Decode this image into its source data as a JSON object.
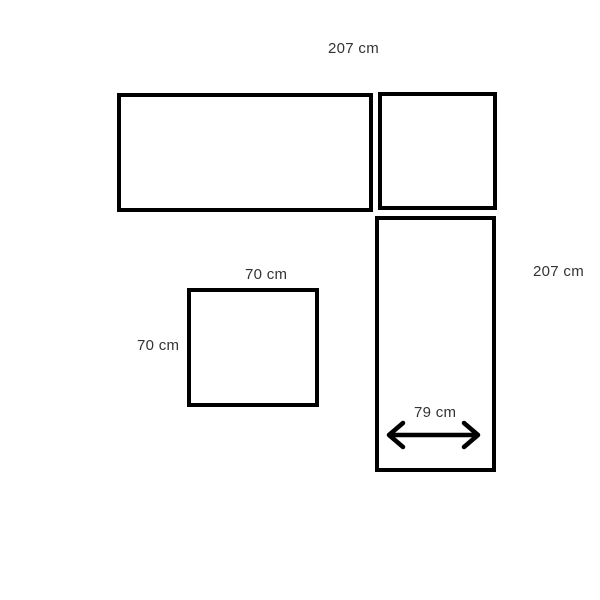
{
  "diagram": {
    "colors": {
      "background": "#ffffff",
      "line": "#000000",
      "text": "#333333"
    },
    "labels": {
      "top_width": "207 cm",
      "right_height": "207 cm",
      "ottoman_width": "70 cm",
      "ottoman_height": "70 cm",
      "seat_width": "79 cm"
    },
    "icons": {
      "seat_width_arrow": "double-headed-horizontal-arrow"
    }
  }
}
